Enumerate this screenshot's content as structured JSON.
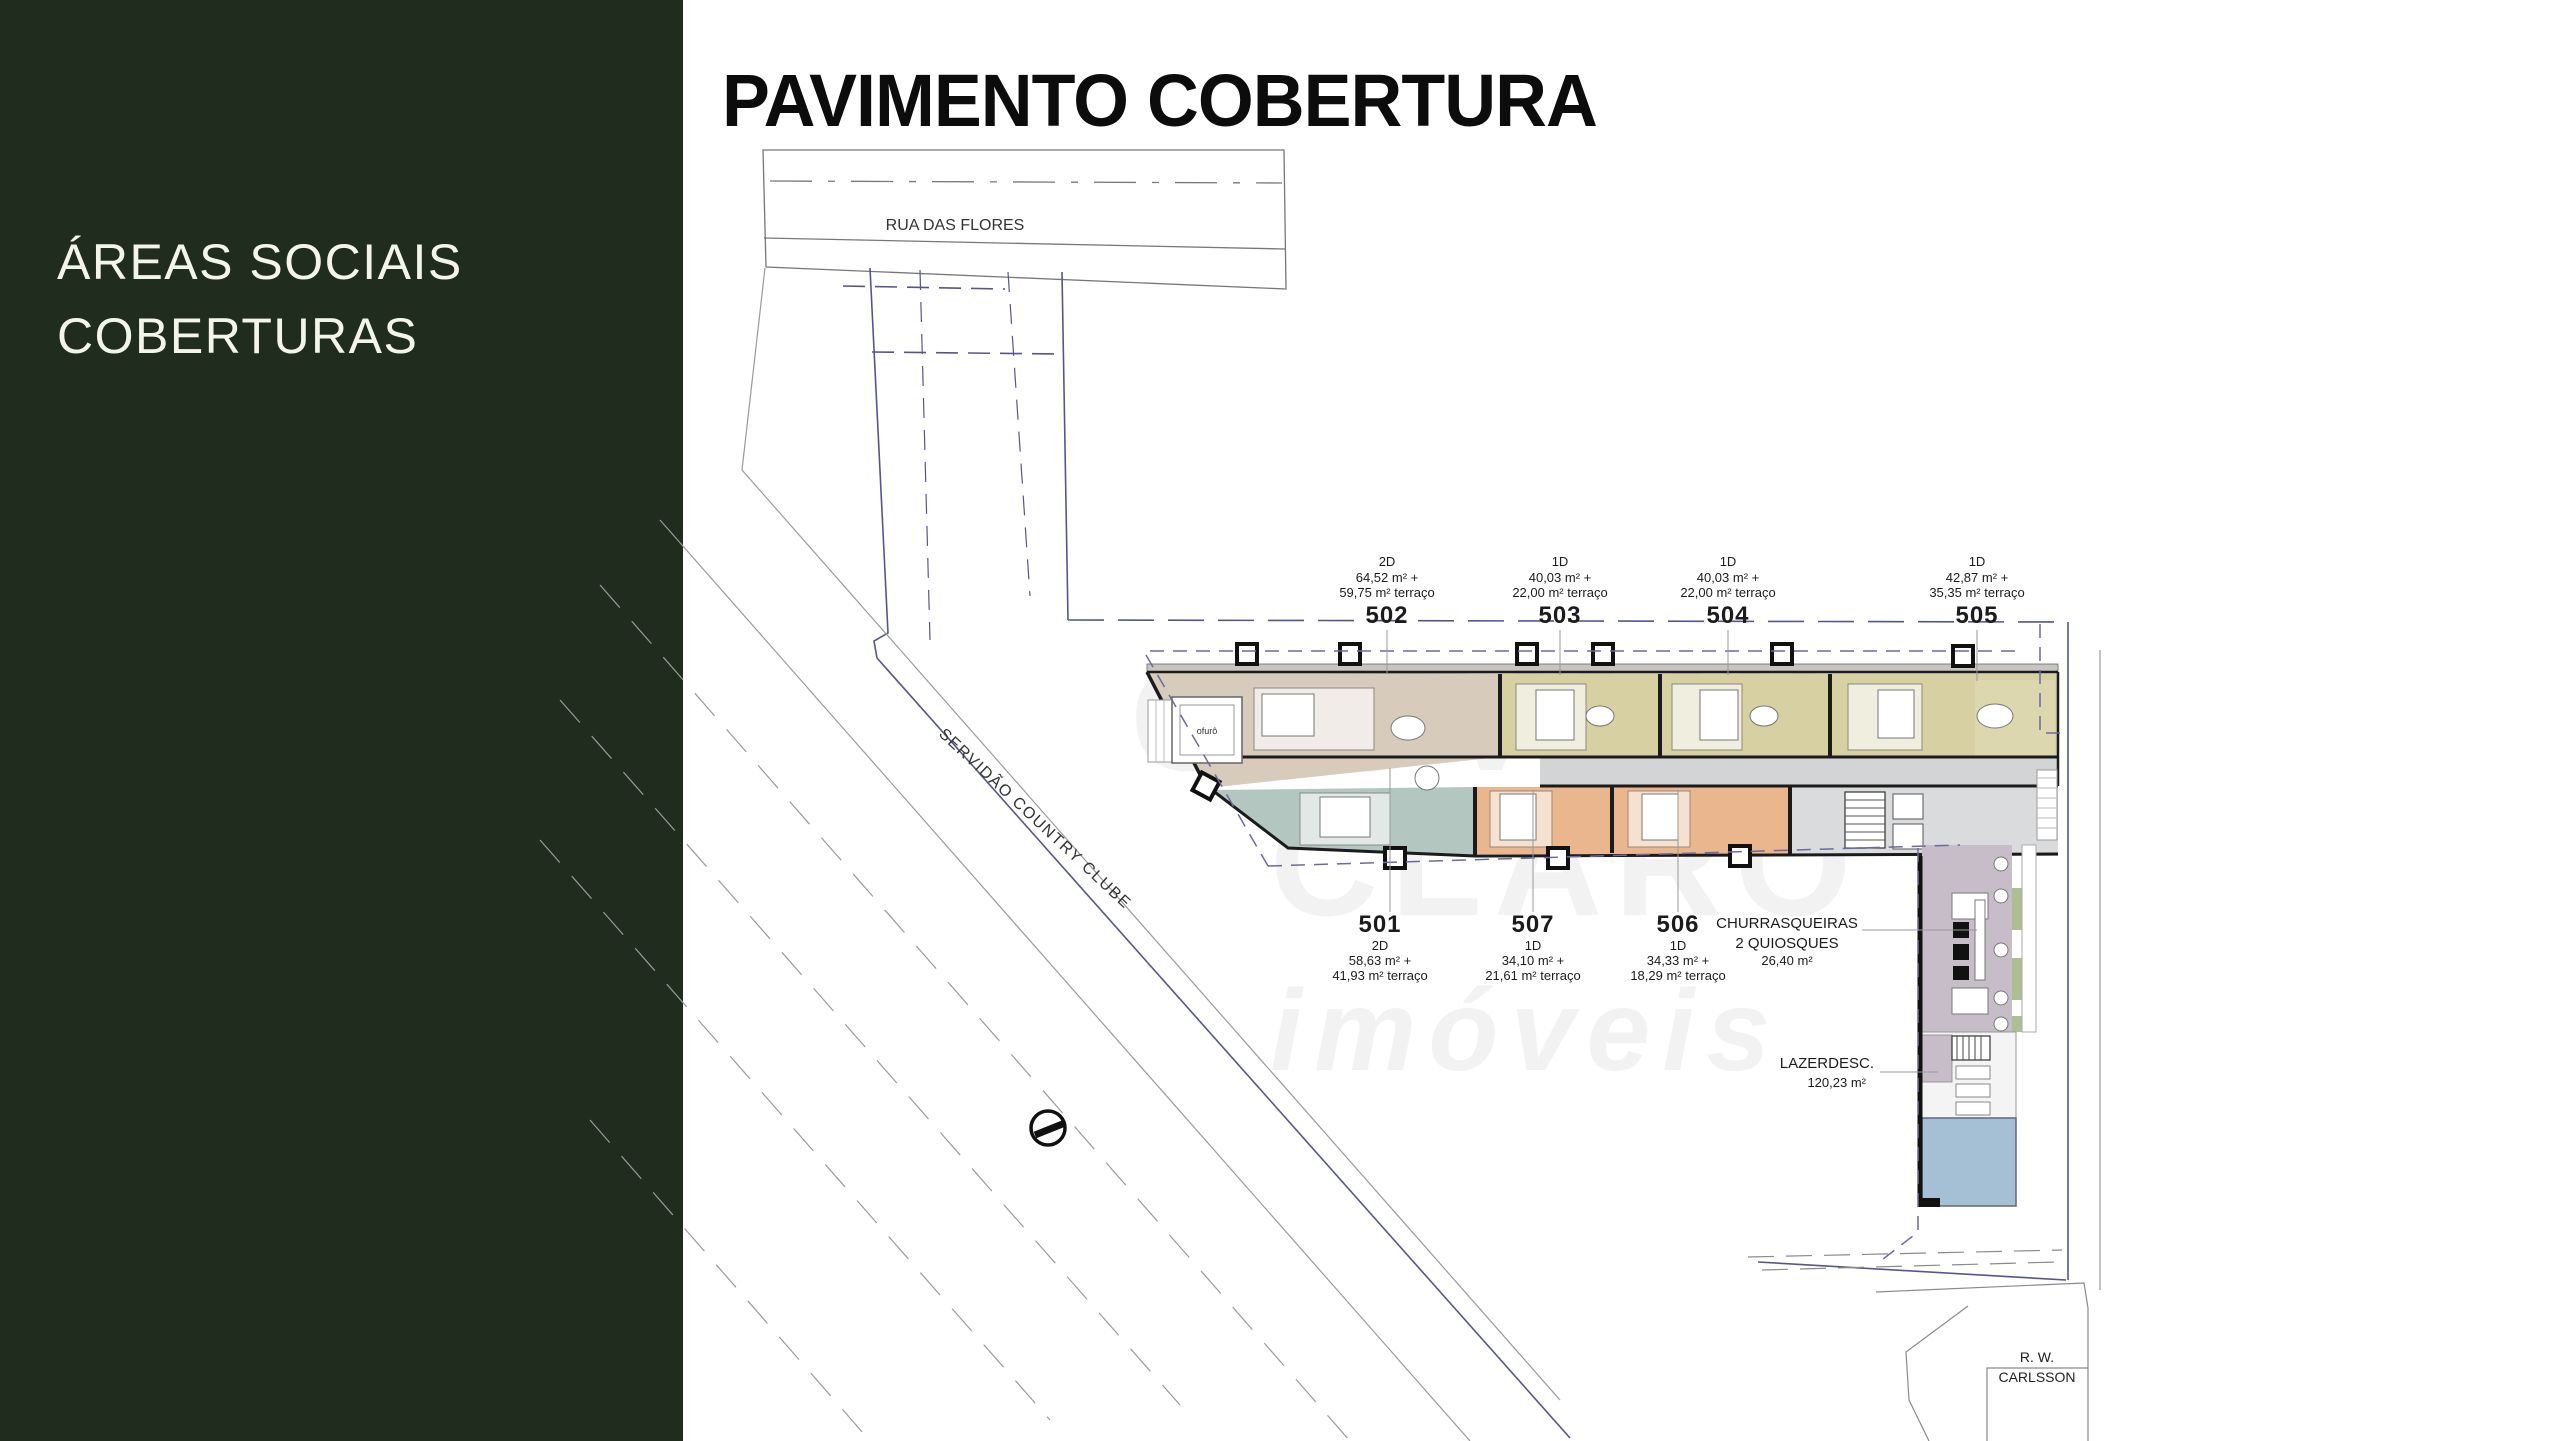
{
  "sidebar": {
    "line1": "ÁREAS SOCIAIS",
    "line2": "COBERTURAS",
    "bg_color": "#1f2c1e",
    "text_color": "#f3f5ea"
  },
  "title": "PAVIMENTO COBERTURA",
  "plan": {
    "streets": {
      "top": "RUA DAS FLORES",
      "diagonal": "SERVIDÃO COUNTRY CLUBE",
      "bottom_right_line1": "R. W.",
      "bottom_right_line2": "CARLSSON"
    },
    "units_top": [
      {
        "id": "502",
        "type": "2D",
        "area": "64,52 m² +",
        "terrace": "59,75 m² terraço"
      },
      {
        "id": "503",
        "type": "1D",
        "area": "40,03 m² +",
        "terrace": "22,00 m² terraço"
      },
      {
        "id": "504",
        "type": "1D",
        "area": "40,03 m² +",
        "terrace": "22,00 m² terraço"
      },
      {
        "id": "505",
        "type": "1D",
        "area": "42,87 m² +",
        "terrace": "35,35 m² terraço"
      }
    ],
    "units_bottom": [
      {
        "id": "501",
        "type": "2D",
        "area": "58,63 m² +",
        "terrace": "41,93 m² terraço"
      },
      {
        "id": "507",
        "type": "1D",
        "area": "34,10 m² +",
        "terrace": "21,61 m² terraço"
      },
      {
        "id": "506",
        "type": "1D",
        "area": "34,33 m² +",
        "terrace": "18,29 m² terraço"
      }
    ],
    "amenities": {
      "churrasqueiras": {
        "line1": "CHURRASQUEIRAS",
        "line2": "2 QUIOSQUES",
        "area": "26,40 m²"
      },
      "lazer": {
        "line1": "LAZERDESC.",
        "area": "120,23 m²"
      }
    },
    "ofuro_label": "ofurô",
    "colors": {
      "unit_502_beige": "#d7cbbb",
      "unit_503_505_olive": "#d6d0a2",
      "unit_501_teal": "#b4c6c0",
      "unit_506_507_orange": "#e9b68e",
      "corridor_gray": "#d2d4d6",
      "terrace_lavender": "#c7bdc9",
      "planter_green": "#aebe93",
      "pool_blue": "#a5c0d4",
      "boundary_navy": "#55558c",
      "wall_black": "#1b1b1b"
    }
  },
  "watermark": {
    "line1": "GIOVANI",
    "line2": "CLARO",
    "line3": "imóveis"
  }
}
